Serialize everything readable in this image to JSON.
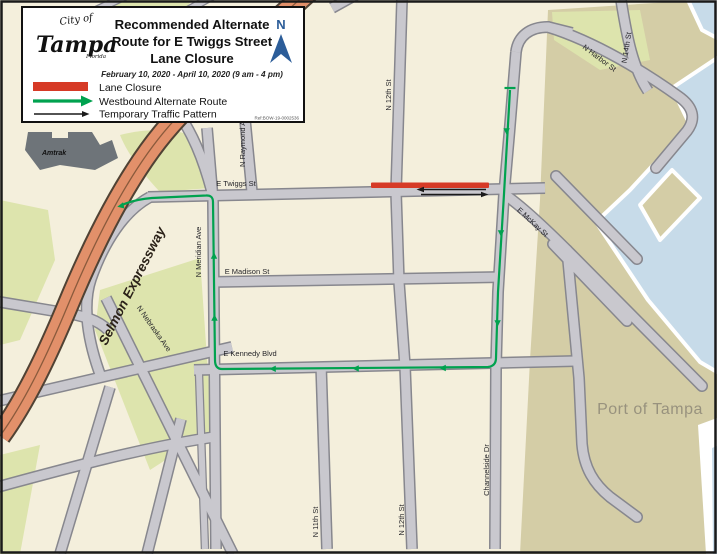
{
  "title": {
    "line1": "Recommended Alternate",
    "line2": "Route for E Twiggs Street",
    "line3": "Lane Closure",
    "date": "February 10, 2020 - April 10, 2020 (9 am - 4 pm)",
    "ref": "Ref:BOW-19-0002536"
  },
  "logo": {
    "city": "City of",
    "name": "Tampa",
    "state": "Florida"
  },
  "north": {
    "label": "N"
  },
  "legend": {
    "items": [
      {
        "label": "Lane Closure"
      },
      {
        "label": "Westbound Alternate Route"
      },
      {
        "label": "Temporary Traffic Pattern"
      }
    ]
  },
  "colors": {
    "closure": "#d63a26",
    "route": "#00a24f",
    "pattern": "#1a1a1a",
    "expressway": "#e2906a",
    "water": "#c7dbe9",
    "park": "#dde4ad",
    "port": "#d4cda6",
    "road": "#c9c8ce",
    "north_blue": "#2c5d99",
    "background": "#f4efdc"
  },
  "streets": {
    "e_twiggs": "E Twiggs St",
    "e_madison": "E Madison St",
    "e_kennedy": "E Kennedy Blvd",
    "n_meridian": "N Meridian Ave",
    "n_raymond": "N Raymond Ave",
    "n_12th_top": "N 12th St",
    "n_12th_bottom": "N 12th St",
    "n_11th": "N 11th St",
    "channelside": "Channelside Dr",
    "e_mckay": "E McKay St",
    "n_harbor": "N Harbor St",
    "n_14th": "N 14th St",
    "n_nebraska": "N Nebraska Ave",
    "selmon": "Selmon Expressway"
  },
  "places": {
    "port": "Port of Tampa",
    "amtrak": "Amtrak"
  }
}
